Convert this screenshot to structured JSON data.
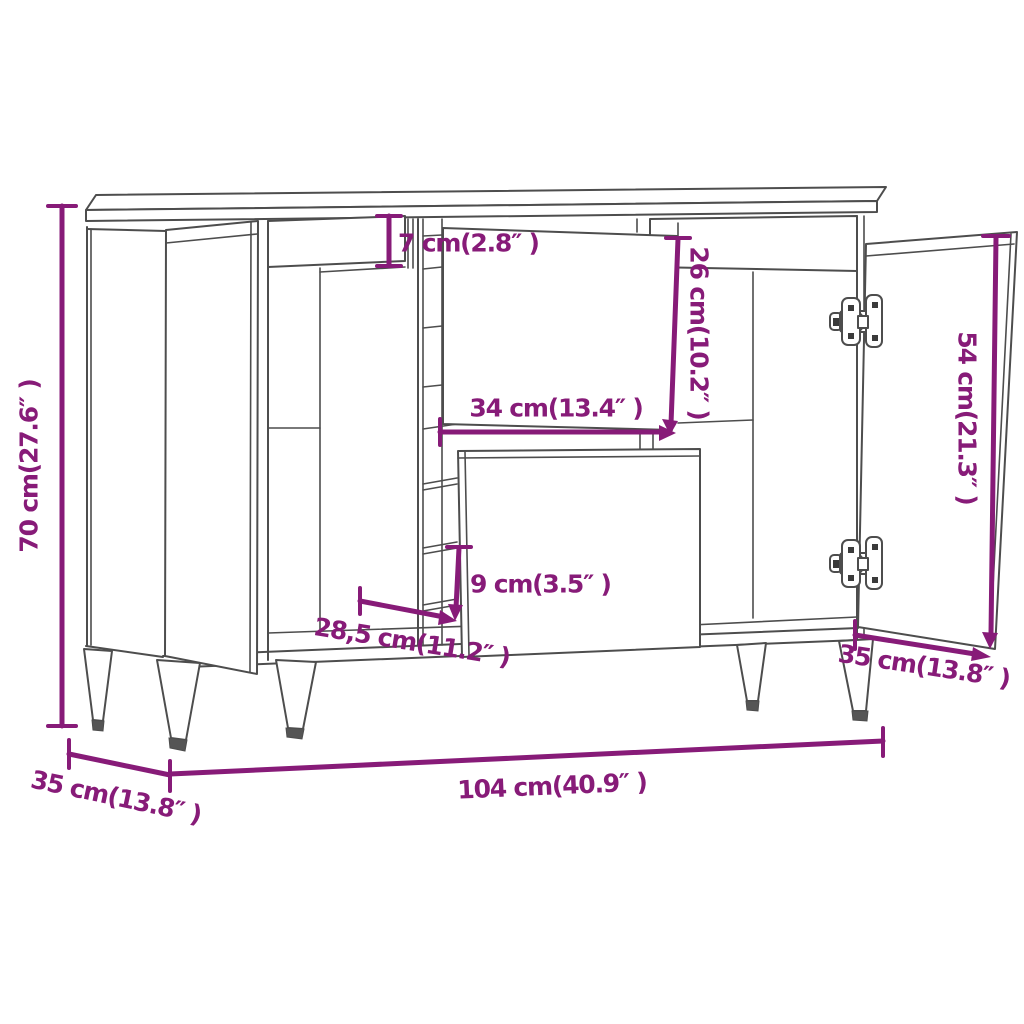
{
  "product": {
    "name": "Sideboard dimension diagram",
    "views": "front perspective with open doors and pulled-out drawer"
  },
  "colors": {
    "dimension_annotation": "#871b78",
    "furniture_outline": "#4d4d4d",
    "background": "#ffffff"
  },
  "dims": {
    "height": {
      "label": "70 cm(27.6″ )"
    },
    "top_drawer_height": {
      "label": "7 cm(2.8″ )"
    },
    "middle_compartment_height": {
      "label": "26 cm(10.2″ )"
    },
    "middle_compartment_width": {
      "label": "34 cm(13.4″ )"
    },
    "door_height": {
      "label": "54 cm(21.3″ )"
    },
    "drawer_height": {
      "label": "9 cm(3.5″ )"
    },
    "drawer_depth": {
      "label": "28,5 cm(11.2″ )"
    },
    "depth_right": {
      "label": "35 cm(13.8″ )"
    },
    "width": {
      "label": "104 cm(40.9″ )"
    },
    "depth_left": {
      "label": "35 cm(13.8″ )"
    }
  }
}
